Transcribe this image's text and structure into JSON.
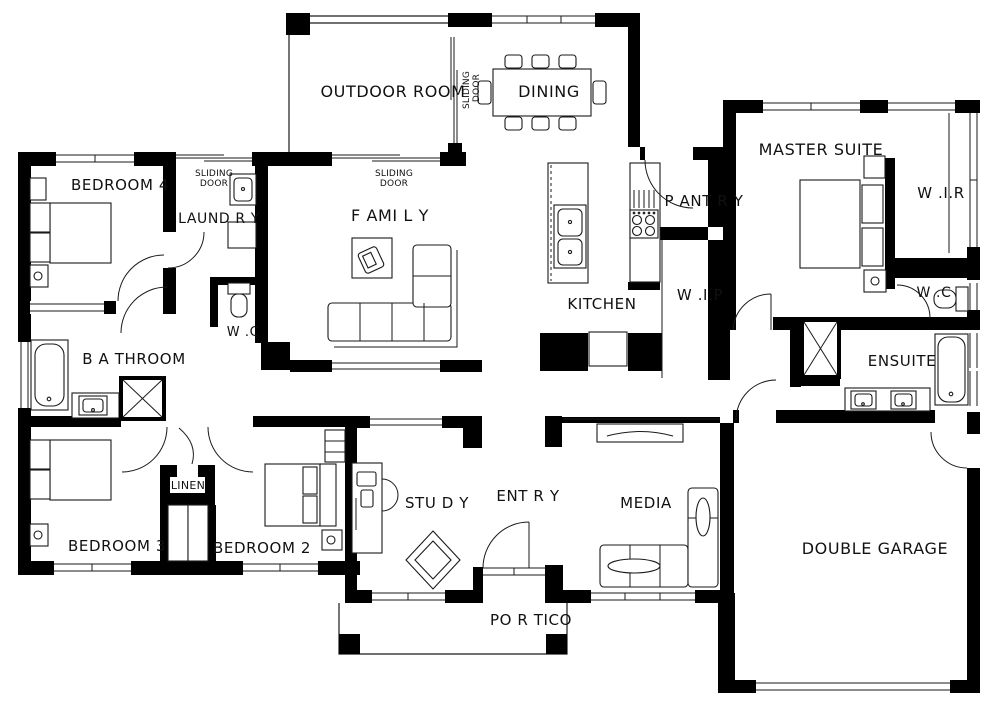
{
  "colors": {
    "wall": "#000000",
    "line": "#1a1a1a",
    "background": "#ffffff",
    "text": "#111111"
  },
  "labels": {
    "outdoor_room": "OUTDOOR ROOM",
    "dining": "DINING",
    "master_suite": "MASTER SUITE",
    "wir": "W .I.R",
    "bedroom4": "BEDROOM 4",
    "sliding_line1": "SLIDING",
    "sliding_line2": "DOOR",
    "laundry": "LAUND R Y",
    "family": "F AMI L Y",
    "pantry": "P ANT R Y",
    "kitchen": "KITCHEN",
    "wip": "W .I.P",
    "wc": "W .C",
    "bathroom": "B A THROOM",
    "ensuite": "ENSUITE",
    "bedroom3": "BEDROOM 3",
    "linen": "LINEN",
    "bedroom2": "BEDROOM 2",
    "study": "STU D Y",
    "entry": "ENT R Y",
    "media": "MEDIA",
    "double_garage": "DOUBLE GARAGE",
    "portico": "PO R TICO"
  }
}
